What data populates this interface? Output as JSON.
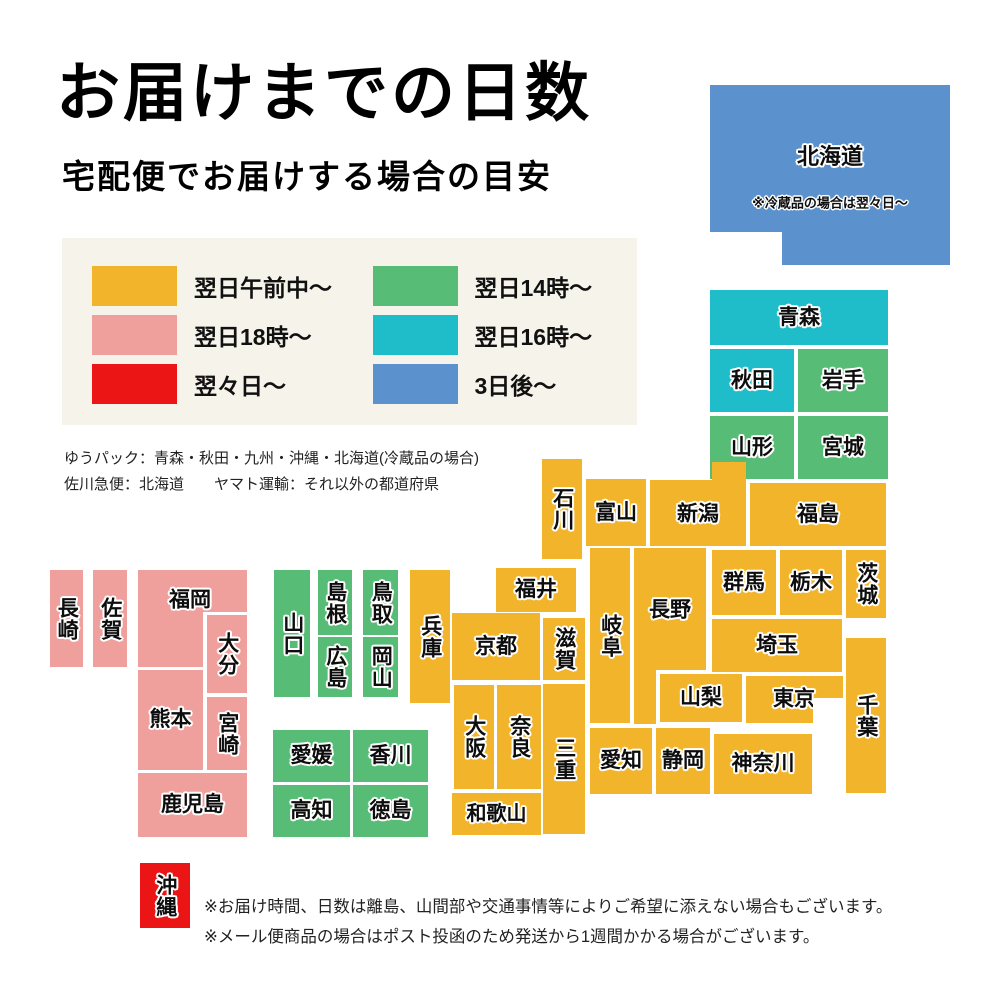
{
  "title": "お届けまでの日数",
  "subtitle": "宅配便でお届けする場合の目安",
  "legend": {
    "bg_color": "#f6f3ea",
    "items": [
      {
        "label": "翌日午前中〜",
        "color_key": "yellow"
      },
      {
        "label": "翌日18時〜",
        "color_key": "pink"
      },
      {
        "label": "翌々日〜",
        "color_key": "red"
      },
      {
        "label": "翌日14時〜",
        "color_key": "green"
      },
      {
        "label": "翌日16時〜",
        "color_key": "cyan"
      },
      {
        "label": "3日後〜",
        "color_key": "blue"
      }
    ]
  },
  "carrier_notes": [
    "ゆうパック：青森・秋田・九州・沖縄・北海道(冷蔵品の場合)",
    "佐川急便：北海道　　ヤマト運輸：それ以外の都道府県"
  ],
  "footer_notes": [
    "※お届け時間、日数は離島、山間部や交通事情等によりご希望に添えない場合もございます。",
    "※メール便商品の場合はポスト投函のため発送から1週間かかる場合がございます。"
  ],
  "map": {
    "palette": {
      "yellow": "#F1B42A",
      "pink": "#F0A09C",
      "red": "#EC1515",
      "green": "#57BC76",
      "cyan": "#1FBDC9",
      "blue": "#5B92CD"
    },
    "regions": [
      {
        "id": "hokkaido",
        "label": "北海道",
        "note": "※冷蔵品の場合は翌々日〜",
        "color": "blue",
        "x": 710,
        "y": 85,
        "w": 240,
        "h": 180,
        "fs": 22,
        "lx": 120,
        "ly": 72,
        "poly": [
          [
            0,
            0
          ],
          [
            240,
            0
          ],
          [
            240,
            180
          ],
          [
            72,
            180
          ],
          [
            72,
            147
          ],
          [
            0,
            147
          ]
        ]
      },
      {
        "id": "aomori",
        "label": "青森",
        "color": "cyan",
        "x": 710,
        "y": 290,
        "w": 178,
        "h": 55
      },
      {
        "id": "akita",
        "label": "秋田",
        "color": "cyan",
        "x": 710,
        "y": 349,
        "w": 84,
        "h": 63
      },
      {
        "id": "iwate",
        "label": "岩手",
        "color": "green",
        "x": 798,
        "y": 349,
        "w": 90,
        "h": 63
      },
      {
        "id": "yamagata",
        "label": "山形",
        "color": "green",
        "x": 710,
        "y": 416,
        "w": 84,
        "h": 63
      },
      {
        "id": "miyagi",
        "label": "宮城",
        "color": "green",
        "x": 798,
        "y": 416,
        "w": 90,
        "h": 63
      },
      {
        "id": "ishikawa",
        "label": "石川",
        "color": "yellow",
        "x": 542,
        "y": 459,
        "w": 40,
        "h": 100,
        "v": true
      },
      {
        "id": "toyama",
        "label": "富山",
        "color": "yellow",
        "x": 586,
        "y": 479,
        "w": 60,
        "h": 67
      },
      {
        "id": "niigata",
        "label": "新潟",
        "color": "yellow",
        "x": 650,
        "y": 462,
        "w": 96,
        "h": 84,
        "lx": 48,
        "ly": 52,
        "poly": [
          [
            0,
            18
          ],
          [
            62,
            18
          ],
          [
            62,
            0
          ],
          [
            96,
            0
          ],
          [
            96,
            84
          ],
          [
            0,
            84
          ]
        ]
      },
      {
        "id": "fukushima",
        "label": "福島",
        "color": "yellow",
        "x": 750,
        "y": 483,
        "w": 136,
        "h": 63
      },
      {
        "id": "gunma",
        "label": "群馬",
        "color": "yellow",
        "x": 712,
        "y": 550,
        "w": 64,
        "h": 65
      },
      {
        "id": "tochigi",
        "label": "栃木",
        "color": "yellow",
        "x": 780,
        "y": 550,
        "w": 62,
        "h": 65
      },
      {
        "id": "ibaraki",
        "label": "茨城",
        "color": "yellow",
        "x": 846,
        "y": 550,
        "w": 40,
        "h": 68,
        "v": true
      },
      {
        "id": "saitama",
        "label": "埼玉",
        "color": "yellow",
        "x": 712,
        "y": 619,
        "w": 130,
        "h": 53
      },
      {
        "id": "chiba",
        "label": "千葉",
        "color": "yellow",
        "x": 846,
        "y": 638,
        "w": 40,
        "h": 155,
        "v": true
      },
      {
        "id": "nagano",
        "label": "長野",
        "color": "yellow",
        "x": 634,
        "y": 548,
        "w": 72,
        "h": 176,
        "lx": 36,
        "ly": 62,
        "poly": [
          [
            0,
            0
          ],
          [
            72,
            0
          ],
          [
            72,
            122
          ],
          [
            22,
            122
          ],
          [
            22,
            176
          ],
          [
            0,
            176
          ]
        ]
      },
      {
        "id": "gifu",
        "label": "岐阜",
        "color": "yellow",
        "x": 590,
        "y": 548,
        "w": 40,
        "h": 175,
        "v": true
      },
      {
        "id": "yamanashi",
        "label": "山梨",
        "color": "yellow",
        "x": 660,
        "y": 674,
        "w": 82,
        "h": 48
      },
      {
        "id": "tokyo",
        "label": "東京",
        "color": "yellow",
        "x": 746,
        "y": 676,
        "w": 97,
        "h": 47,
        "lx": 48,
        "ly": 23,
        "poly": [
          [
            0,
            0
          ],
          [
            97,
            0
          ],
          [
            97,
            22
          ],
          [
            67,
            22
          ],
          [
            67,
            47
          ],
          [
            0,
            47
          ]
        ]
      },
      {
        "id": "kanagawa",
        "label": "神奈川",
        "color": "yellow",
        "x": 714,
        "y": 734,
        "w": 98,
        "h": 60
      },
      {
        "id": "fukui",
        "label": "福井",
        "color": "yellow",
        "x": 496,
        "y": 568,
        "w": 80,
        "h": 44
      },
      {
        "id": "shiga",
        "label": "滋賀",
        "color": "yellow",
        "x": 543,
        "y": 618,
        "w": 42,
        "h": 62,
        "v": true
      },
      {
        "id": "kyoto",
        "label": "京都",
        "color": "yellow",
        "x": 452,
        "y": 613,
        "w": 88,
        "h": 67
      },
      {
        "id": "mie",
        "label": "三重",
        "color": "yellow",
        "x": 543,
        "y": 684,
        "w": 42,
        "h": 150,
        "v": true
      },
      {
        "id": "osaka",
        "label": "大阪",
        "color": "yellow",
        "x": 454,
        "y": 685,
        "w": 40,
        "h": 104,
        "v": true
      },
      {
        "id": "nara",
        "label": "奈良",
        "color": "yellow",
        "x": 497,
        "y": 685,
        "w": 44,
        "h": 104,
        "v": true
      },
      {
        "id": "wakayama",
        "label": "和歌山",
        "color": "yellow",
        "x": 452,
        "y": 793,
        "w": 89,
        "h": 42,
        "fs": 20
      },
      {
        "id": "aichi",
        "label": "愛知",
        "color": "yellow",
        "x": 590,
        "y": 728,
        "w": 62,
        "h": 66
      },
      {
        "id": "shizuoka",
        "label": "静岡",
        "color": "yellow",
        "x": 656,
        "y": 728,
        "w": 54,
        "h": 66
      },
      {
        "id": "hyogo",
        "label": "兵庫",
        "color": "yellow",
        "x": 410,
        "y": 570,
        "w": 40,
        "h": 133,
        "v": true
      },
      {
        "id": "yamaguchi",
        "label": "山口",
        "color": "green",
        "x": 274,
        "y": 570,
        "w": 36,
        "h": 127,
        "v": true
      },
      {
        "id": "shimane",
        "label": "島根",
        "color": "green",
        "x": 318,
        "y": 570,
        "w": 34,
        "h": 65,
        "v": true
      },
      {
        "id": "tottori",
        "label": "鳥取",
        "color": "green",
        "x": 363,
        "y": 570,
        "w": 35,
        "h": 65,
        "v": true
      },
      {
        "id": "hiroshima",
        "label": "広島",
        "color": "green",
        "x": 318,
        "y": 637,
        "w": 34,
        "h": 60,
        "v": true
      },
      {
        "id": "okayama",
        "label": "岡山",
        "color": "green",
        "x": 363,
        "y": 637,
        "w": 35,
        "h": 60,
        "v": true
      },
      {
        "id": "ehime",
        "label": "愛媛",
        "color": "green",
        "x": 273,
        "y": 730,
        "w": 77,
        "h": 52
      },
      {
        "id": "kagawa",
        "label": "香川",
        "color": "green",
        "x": 353,
        "y": 730,
        "w": 75,
        "h": 52
      },
      {
        "id": "kochi",
        "label": "高知",
        "color": "green",
        "x": 273,
        "y": 785,
        "w": 77,
        "h": 52
      },
      {
        "id": "tokushima",
        "label": "徳島",
        "color": "green",
        "x": 353,
        "y": 785,
        "w": 75,
        "h": 52
      },
      {
        "id": "nagasaki",
        "label": "長崎",
        "color": "pink",
        "x": 50,
        "y": 570,
        "w": 33,
        "h": 97,
        "v": true
      },
      {
        "id": "saga",
        "label": "佐賀",
        "color": "pink",
        "x": 93,
        "y": 570,
        "w": 34,
        "h": 97,
        "v": true
      },
      {
        "id": "fukuoka",
        "label": "福岡",
        "color": "pink",
        "x": 138,
        "y": 570,
        "w": 109,
        "h": 97,
        "lx": 52,
        "ly": 30,
        "poly": [
          [
            0,
            0
          ],
          [
            109,
            0
          ],
          [
            109,
            42
          ],
          [
            65,
            42
          ],
          [
            65,
            97
          ],
          [
            0,
            97
          ]
        ]
      },
      {
        "id": "oita",
        "label": "大分",
        "color": "pink",
        "x": 207,
        "y": 615,
        "w": 40,
        "h": 78,
        "v": true
      },
      {
        "id": "kumamoto",
        "label": "熊本",
        "color": "pink",
        "x": 138,
        "y": 670,
        "w": 65,
        "h": 100
      },
      {
        "id": "miyazaki",
        "label": "宮崎",
        "color": "pink",
        "x": 207,
        "y": 697,
        "w": 40,
        "h": 73,
        "v": true
      },
      {
        "id": "kagoshima",
        "label": "鹿児島",
        "color": "pink",
        "x": 138,
        "y": 773,
        "w": 109,
        "h": 64
      },
      {
        "id": "okinawa",
        "label": "沖縄",
        "color": "red",
        "x": 140,
        "y": 863,
        "w": 50,
        "h": 65,
        "v": true
      }
    ]
  }
}
